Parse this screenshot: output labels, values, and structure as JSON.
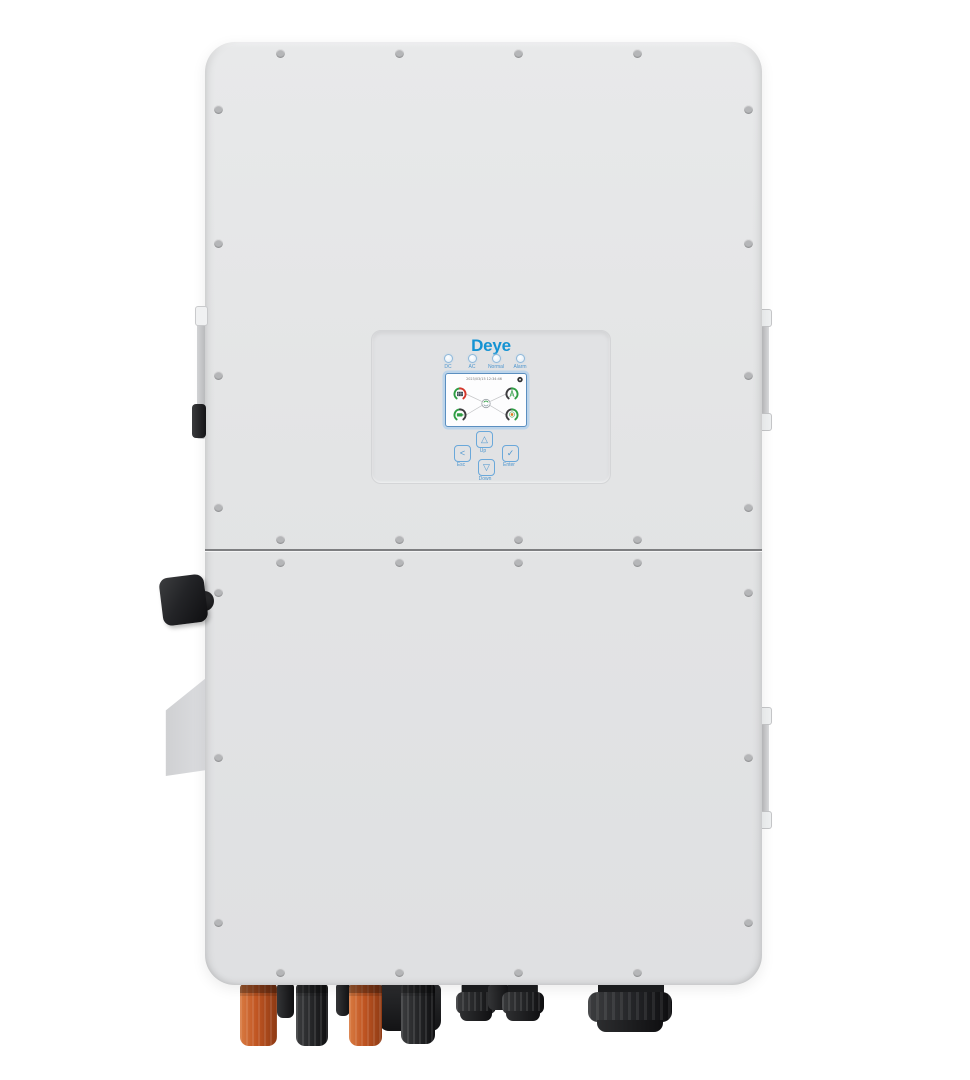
{
  "brand": {
    "logo_text": "Deye"
  },
  "status_leds": [
    {
      "label": "DC"
    },
    {
      "label": "AC"
    },
    {
      "label": "Normal"
    },
    {
      "label": "Alarm"
    }
  ],
  "lcd": {
    "datetime": "2023/03/15 12:34:46",
    "gauges": [
      {
        "name": "pv-solar"
      },
      {
        "name": "grid"
      },
      {
        "name": "battery"
      },
      {
        "name": "load"
      }
    ]
  },
  "buttons": {
    "esc": {
      "glyph": "<",
      "label": "Esc"
    },
    "up": {
      "glyph": "△",
      "label": "Up"
    },
    "down": {
      "glyph": "▽",
      "label": "Down"
    },
    "enter": {
      "glyph": "✓",
      "label": "Enter"
    }
  },
  "colors": {
    "logo_blue": "#1493d3",
    "button_blue": "#4d96cf",
    "gauge_green": "#2f9e44",
    "gauge_red": "#d4372c",
    "gauge_dark": "#3c3c3e",
    "mc4_orange": "#c05522",
    "connector_black": "#232426",
    "enclosure_gray": "#e3e4e5"
  }
}
